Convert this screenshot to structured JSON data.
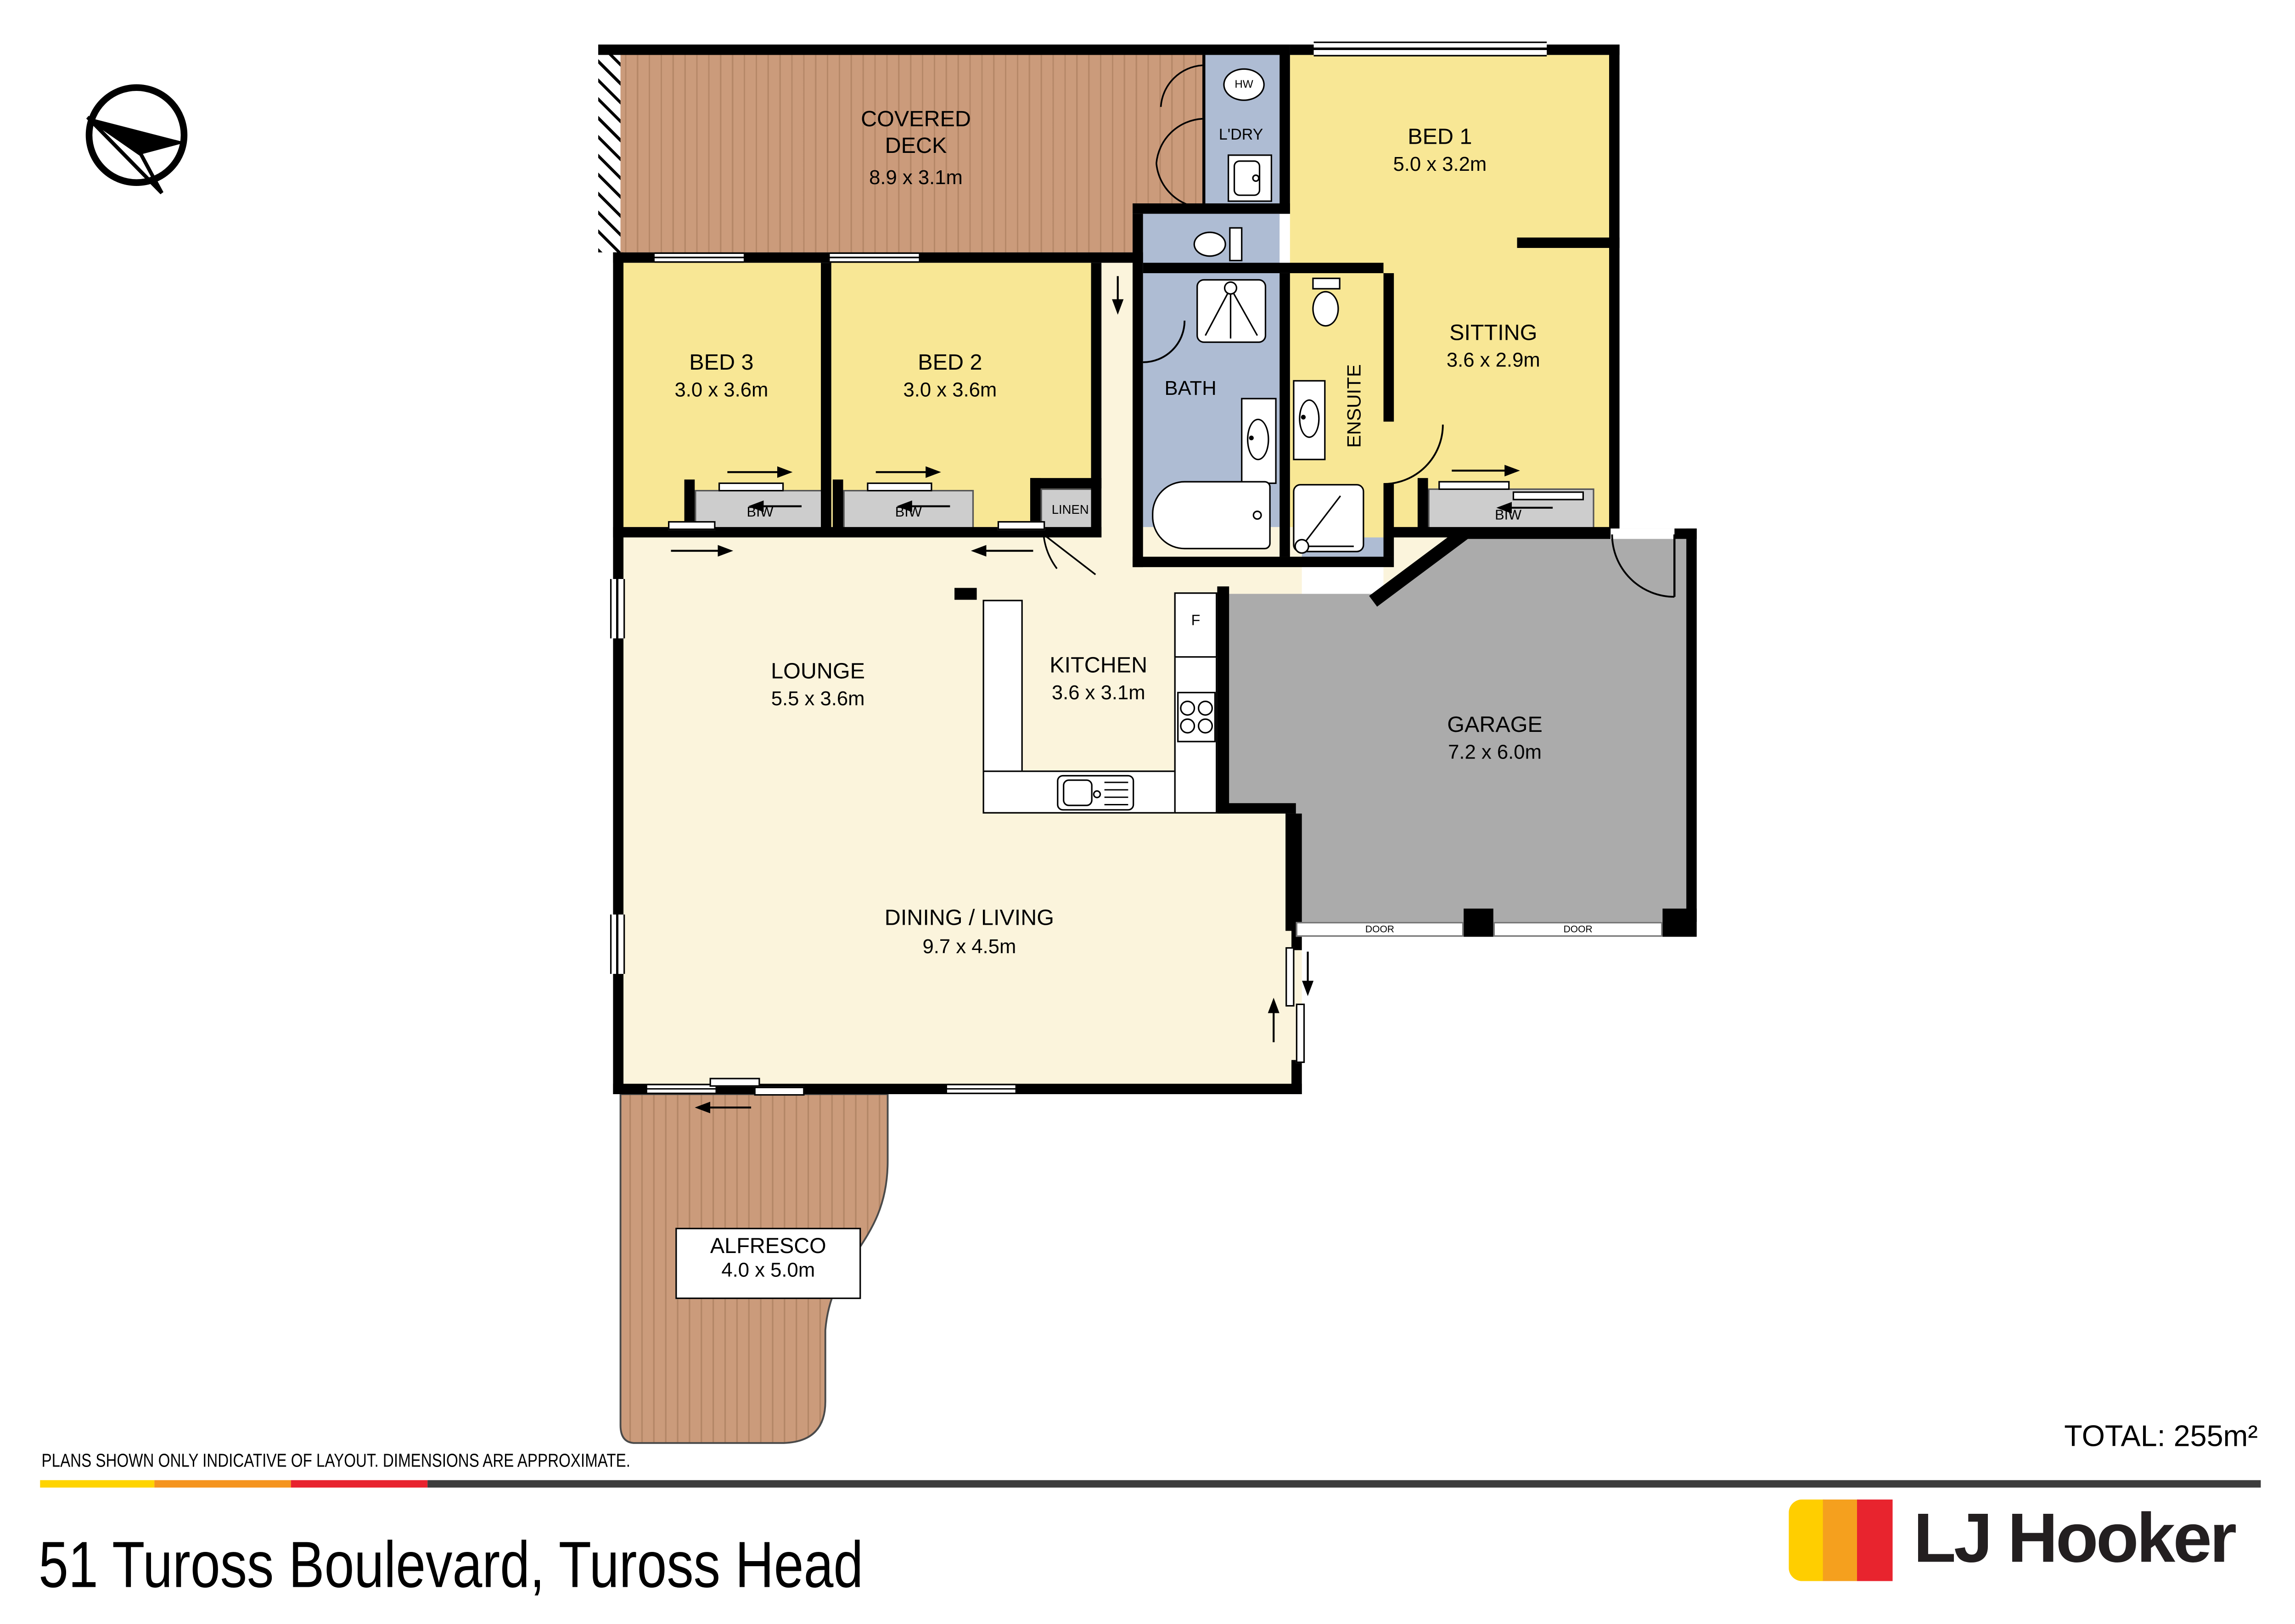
{
  "palette": {
    "yellow": "#F8E795",
    "cream": "#FBF4DC",
    "wet": "#AEBCD3",
    "garage": "#ABABAB",
    "closet": "#CDCDCD",
    "deck": "#CB9B7B",
    "wall": "#000000",
    "brand_dark": "#231F20"
  },
  "rooms": {
    "deck": {
      "name": "COVERED DECK",
      "dims": "8.9 x 3.1m"
    },
    "bed1": {
      "name": "BED 1",
      "dims": "5.0 x 3.2m"
    },
    "sitting": {
      "name": "SITTING",
      "dims": "3.6 x 2.9m"
    },
    "bed3": {
      "name": "BED 3",
      "dims": "3.0 x 3.6m"
    },
    "bed2": {
      "name": "BED 2",
      "dims": "3.0 x 3.6m"
    },
    "lounge": {
      "name": "LOUNGE",
      "dims": "5.5 x 3.6m"
    },
    "kitchen": {
      "name": "KITCHEN",
      "dims": "3.6 x 3.1m"
    },
    "dining": {
      "name": "DINING / LIVING",
      "dims": "9.7 x 4.5m"
    },
    "garage": {
      "name": "GARAGE",
      "dims": "7.2 x 6.0m"
    },
    "alfresco": {
      "name": "ALFRESCO",
      "dims": "4.0 x 5.0m"
    },
    "bath": {
      "name": "BATH"
    },
    "ensuite": {
      "name": "ENSUITE"
    },
    "laundry": {
      "name": "L'DRY"
    },
    "hw": {
      "name": "HW"
    },
    "fridge": {
      "name": "F"
    }
  },
  "closets": {
    "biw": "BIW",
    "linen": "LINEN"
  },
  "garage_doors": {
    "left": "DOOR",
    "right": "DOOR"
  },
  "footer": {
    "disclaimer": "PLANS SHOWN ONLY INDICATIVE OF LAYOUT.  DIMENSIONS ARE APPROXIMATE.",
    "total": "TOTAL: 255m²",
    "address": "51 Tuross Boulevard, Tuross Head"
  },
  "brand": {
    "name": "LJ Hooker",
    "stripe_yellow": "#FFCE00",
    "stripe_orange": "#F5A01E",
    "stripe_red": "#E8242E",
    "rule_yellow": "#FFD400",
    "rule_orange": "#F5941E",
    "rule_red": "#E8232E",
    "rule_dark": "#3D3D3D"
  }
}
